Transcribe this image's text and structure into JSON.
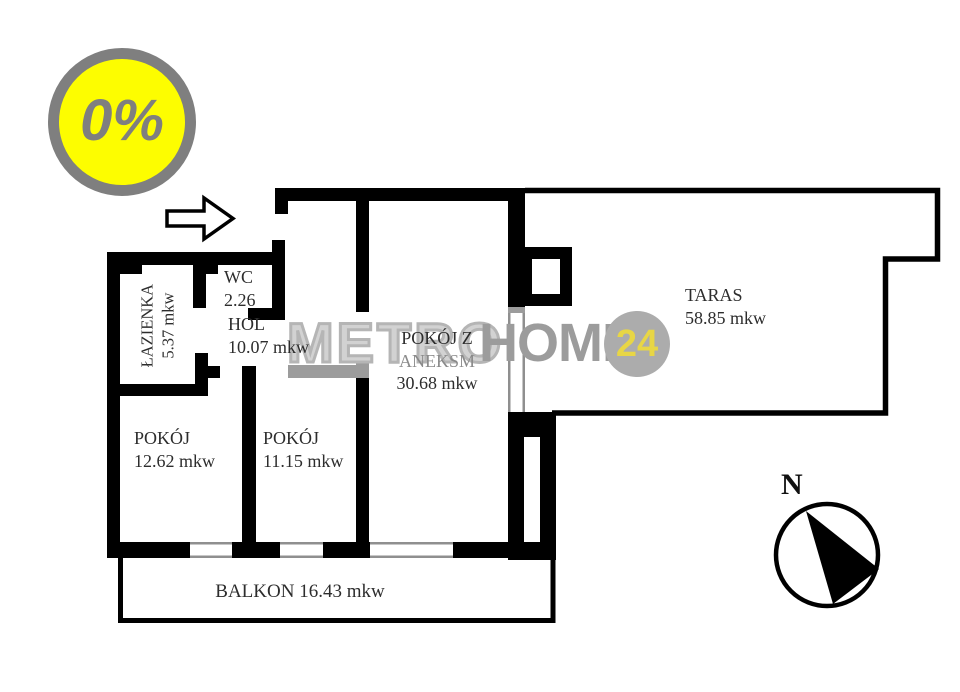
{
  "promo_badge": {
    "label": "0%",
    "fill": "#fdfd00",
    "ring": "#7f7f7f"
  },
  "watermark": {
    "metro": "METRO",
    "home": "HOME",
    "badge": "24",
    "gray": "#9c9c9c",
    "yellow": "#e8d645"
  },
  "rooms": {
    "lazienka": {
      "name": "ŁAZIENKA",
      "area": "5.37 mkw"
    },
    "wc": {
      "name": "WC",
      "area": "2.26"
    },
    "hol": {
      "name": "HOL",
      "area": "10.07 mkw"
    },
    "pokoj_z_aneksem": {
      "line1": "POKÓJ Z",
      "line2": "ANEKSM",
      "area": "30.68 mkw"
    },
    "taras": {
      "name": "TARAS",
      "area": "58.85 mkw"
    },
    "pokoj_1": {
      "name": "POKÓJ",
      "area": "12.62 mkw"
    },
    "pokoj_2": {
      "name": "POKÓJ",
      "area": "11.15 mkw"
    },
    "balkon": {
      "label": "BALKON 16.43 mkw"
    }
  },
  "compass": {
    "label": "N"
  },
  "icons": {
    "entrance_arrow": "arrow-right",
    "compass_needle": "needle-southeast"
  }
}
